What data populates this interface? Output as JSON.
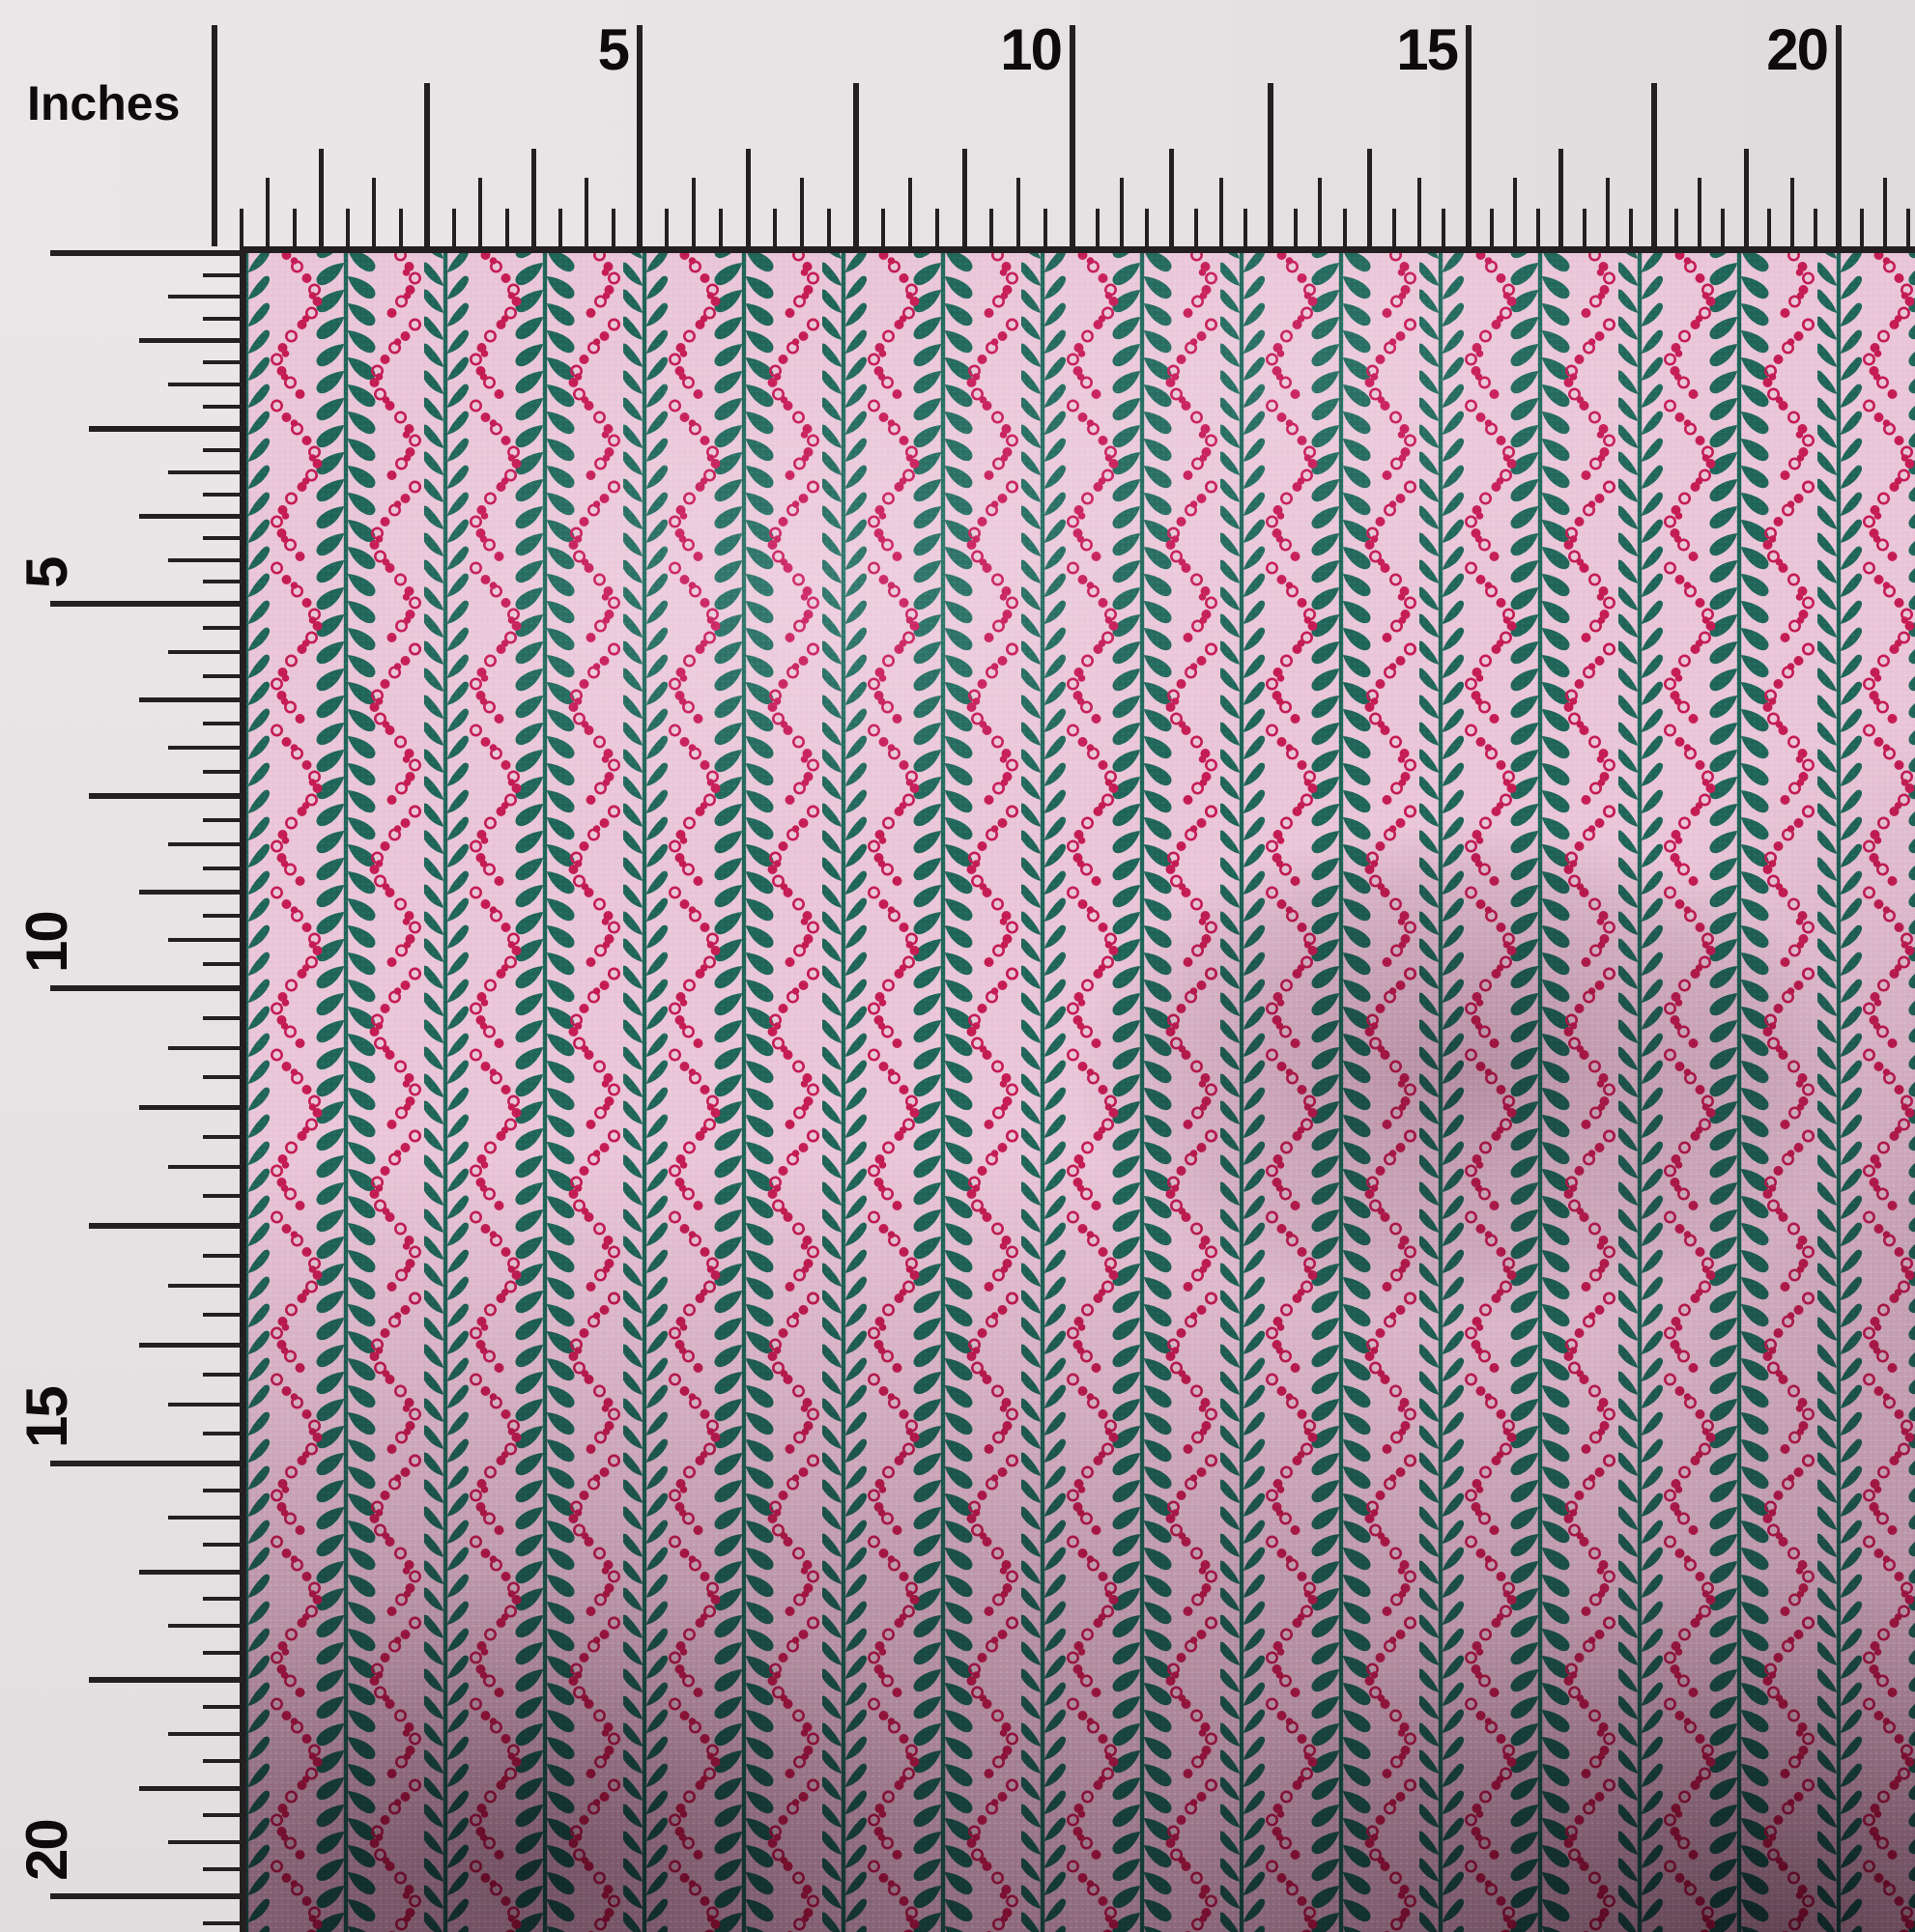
{
  "photo": {
    "description": "Fabric swatch photographed with printed inch rulers along the top and left edges"
  },
  "rulers": {
    "unit_label": "Inches",
    "top_labels": [
      "5",
      "10",
      "15",
      "20"
    ],
    "left_labels": [
      "5",
      "10",
      "15",
      "20"
    ]
  },
  "colors": {
    "ruler_background": "#e7e4e5",
    "tick_black": "#242021",
    "fabric_pink": "#e9c5d7",
    "leaf_teal": "#206458",
    "dot_crimson": "#c31c52",
    "shadow_plum": "#3a1630"
  },
  "fabric": {
    "description": "Pink crepe fabric with vertical teal leaf-vine stripes and crimson dotted chevron columns",
    "visible_vine_columns": 17
  }
}
